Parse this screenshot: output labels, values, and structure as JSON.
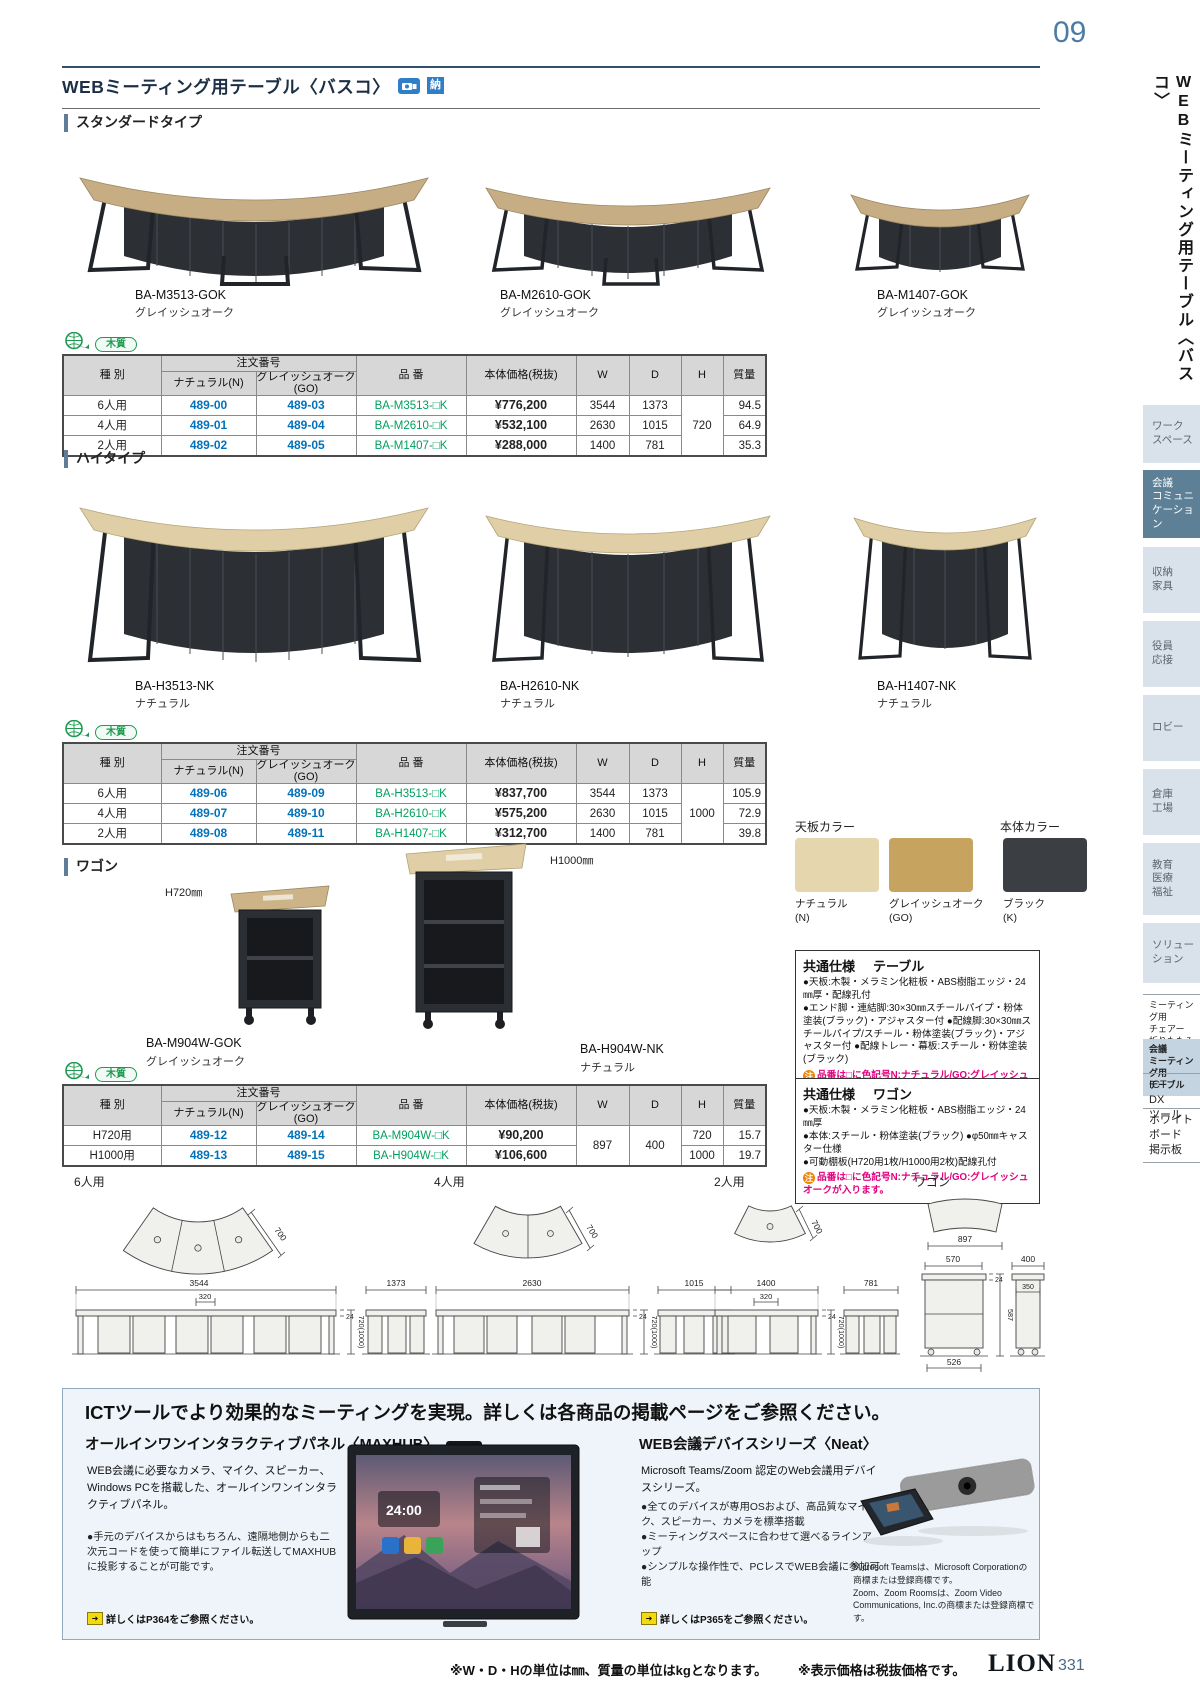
{
  "page": {
    "corner_number": "09",
    "footer": {
      "note1": "※W・D・Hの単位は㎜、質量の単位はkgとなります。",
      "note2": "※表示価格は税抜価格です。",
      "brand": "LION",
      "page_number": "331"
    }
  },
  "header": {
    "title": "WEBミーティング用テーブル〈バスコ〉",
    "delivery_badge": "納"
  },
  "sidebar": {
    "vertical_title": "WEBミーティング用テーブル〈バスコ〉",
    "tabs": [
      {
        "label": "ワーク\nスペース"
      },
      {
        "label": "会議\nコミュニ\nケーション"
      },
      {
        "label": "収納\n家具"
      },
      {
        "label": "役員\n応接"
      },
      {
        "label": "ロビー"
      },
      {
        "label": "倉庫\n工場"
      },
      {
        "label": "教育\n医療\n福祉"
      },
      {
        "label": "ソリュー\nション"
      },
      {
        "label": "ミーティング用\nチェアー\n折りたたみイス"
      },
      {
        "label": "会議\nミーティング用\nテーブル"
      },
      {
        "label": "ICT\nDX\nツール"
      },
      {
        "label": "ホワイト\nボード\n掲示板"
      }
    ]
  },
  "badges": {
    "wood": "木質"
  },
  "table_headers": {
    "type": "種 別",
    "order": "注文番号",
    "n": "ナチュラル(N)",
    "go": "グレイッシュオーク(GO)",
    "item": "品 番",
    "price": "本体価格(税抜)",
    "w": "W",
    "d": "D",
    "h": "H",
    "weight": "質量"
  },
  "standard": {
    "label": "スタンダードタイプ",
    "products": [
      {
        "code": "BA-M3513-GOK",
        "color": "グレイッシュオーク"
      },
      {
        "code": "BA-M2610-GOK",
        "color": "グレイッシュオーク"
      },
      {
        "code": "BA-M1407-GOK",
        "color": "グレイッシュオーク"
      }
    ],
    "rows": [
      {
        "type": "6人用",
        "n": "489-00",
        "go": "489-03",
        "item": "BA-M3513-□K",
        "price": "¥776,200",
        "w": "3544",
        "d": "1373",
        "weight": "94.5"
      },
      {
        "type": "4人用",
        "n": "489-01",
        "go": "489-04",
        "item": "BA-M2610-□K",
        "price": "¥532,100",
        "w": "2630",
        "d": "1015",
        "weight": "64.9"
      },
      {
        "type": "2人用",
        "n": "489-02",
        "go": "489-05",
        "item": "BA-M1407-□K",
        "price": "¥288,000",
        "w": "1400",
        "d": "781",
        "weight": "35.3"
      }
    ],
    "h_merged": "720"
  },
  "high": {
    "label": "ハイタイプ",
    "products": [
      {
        "code": "BA-H3513-NK",
        "color": "ナチュラル"
      },
      {
        "code": "BA-H2610-NK",
        "color": "ナチュラル"
      },
      {
        "code": "BA-H1407-NK",
        "color": "ナチュラル"
      }
    ],
    "rows": [
      {
        "type": "6人用",
        "n": "489-06",
        "go": "489-09",
        "item": "BA-H3513-□K",
        "price": "¥837,700",
        "w": "3544",
        "d": "1373",
        "weight": "105.9"
      },
      {
        "type": "4人用",
        "n": "489-07",
        "go": "489-10",
        "item": "BA-H2610-□K",
        "price": "¥575,200",
        "w": "2630",
        "d": "1015",
        "weight": "72.9"
      },
      {
        "type": "2人用",
        "n": "489-08",
        "go": "489-11",
        "item": "BA-H1407-□K",
        "price": "¥312,700",
        "w": "1400",
        "d": "781",
        "weight": "39.8"
      }
    ],
    "h_merged": "1000"
  },
  "wagon": {
    "label": "ワゴン",
    "products": [
      {
        "code": "BA-M904W-GOK",
        "color": "グレイッシュオーク",
        "height_tag": "H720㎜"
      },
      {
        "code": "BA-H904W-NK",
        "color": "ナチュラル",
        "height_tag": "H1000㎜"
      }
    ],
    "rows": [
      {
        "type": "H720用",
        "n": "489-12",
        "go": "489-14",
        "item": "BA-M904W-□K",
        "price": "¥90,200",
        "h": "720",
        "weight": "15.7"
      },
      {
        "type": "H1000用",
        "n": "489-13",
        "go": "489-15",
        "item": "BA-H904W-□K",
        "price": "¥106,600",
        "h": "1000",
        "weight": "19.7"
      }
    ],
    "w_merged": "897",
    "d_merged": "400"
  },
  "colors": {
    "top_title": "天板カラー",
    "body_title": "本体カラー",
    "swatches": [
      {
        "name": "ナチュラル",
        "code": "(N)",
        "hex": "#e6d6ae"
      },
      {
        "name": "グレイッシュオーク",
        "code": "(GO)",
        "hex": "#c7a360"
      },
      {
        "name": "ブラック",
        "code": "(K)",
        "hex": "#3b3e43"
      }
    ]
  },
  "spec_table": {
    "title": "共通仕様",
    "subtitle": "テーブル",
    "lines": [
      "●天板:木製・メラミン化粧板・ABS樹脂エッジ・24㎜厚・配線孔付",
      "●エンド脚・連結脚:30×30㎜スチールパイプ・粉体塗装(ブラック)・アジャスター付 ●配線脚:30×30㎜スチールパイプ/スチール・粉体塗装(ブラック)・アジャスター付 ●配線トレー・幕板:スチール・粉体塗装(ブラック)"
    ],
    "note_badge": "注",
    "note": "品番は□に色記号N:ナチュラル/GO:グレイッシュオークが入ります。"
  },
  "spec_wagon": {
    "title": "共通仕様",
    "subtitle": "ワゴン",
    "lines": [
      "●天板:木製・メラミン化粧板・ABS樹脂エッジ・24㎜厚",
      "●本体:スチール・粉体塗装(ブラック) ●φ50㎜キャスター仕様",
      "●可動棚板(H720用1枚/H1000用2枚)配線孔付"
    ],
    "note_badge": "注",
    "note": "品番は□に色記号N:ナチュラル/GO:グレイッシュオークが入ります。"
  },
  "diagrams": {
    "six": {
      "label": "6人用",
      "depth": "700",
      "w": "3544",
      "w2": "320",
      "t": "24",
      "h": "720(1000)",
      "side": "1373"
    },
    "four": {
      "label": "4人用",
      "depth": "700",
      "w": "2630",
      "t": "24",
      "h": "720(1000)",
      "side": "1015"
    },
    "two": {
      "label": "2人用",
      "depth": "700",
      "w": "1400",
      "w2": "320",
      "t": "24",
      "h": "720(1000)",
      "side": "781"
    },
    "wagon": {
      "label": "ワゴン",
      "top_w": "897",
      "front_w": "570",
      "t": "24",
      "h": "587",
      "bottom_w": "526",
      "side_w": "400",
      "side_w2": "350"
    }
  },
  "ict": {
    "title": "ICTツールでより効果的なミーティングを実現。詳しくは各商品の掲載ページをご参照ください。",
    "maxhub": {
      "title": "オールインワンインタラクティブパネル〈MAXHUB〉",
      "body": "WEB会議に必要なカメラ、マイク、スピーカー、Windows PCを搭載した、オールインワンインタラクティブパネル。",
      "bullet": "●手元のデバイスからはもちろん、遠隔地側からも二次元コードを使って簡単にファイル転送してMAXHUBに投影することが可能です。",
      "link": "詳しくはP364をご参照ください。",
      "screen_time": "24:00"
    },
    "neat": {
      "title": "WEB会議デバイスシリーズ〈Neat〉",
      "body": "Microsoft Teams/Zoom 認定のWeb会議用デバイスシリーズ。",
      "bullets": [
        "●全てのデバイスが専用OSおよび、高品質なマイク、スピーカー、カメラを標準搭載",
        "●ミーティングスペースに合わせて選べるラインアップ",
        "●シンプルな操作性で、PCレスでWEB会議に参加可能"
      ],
      "link": "詳しくはP365をご参照ください。",
      "trademark1": "Microsoft Teamsは、Microsoft Corporationの商標または登録商標です。",
      "trademark2": "Zoom、Zoom Roomsは、Zoom Video Communications, Inc.の商標または登録商標です。"
    }
  }
}
